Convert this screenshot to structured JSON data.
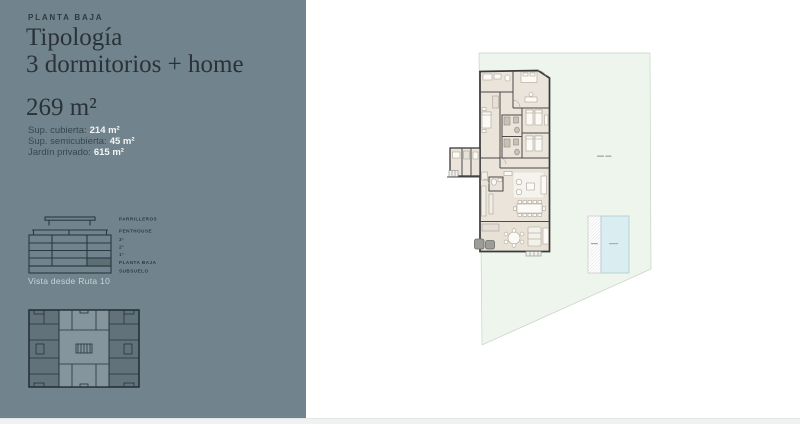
{
  "sidebar": {
    "eyebrow": "PLANTA BAJA",
    "title_line1": "Tipología",
    "title_line2": "3 dormitorios + home",
    "total_area": "269 m²",
    "details": [
      {
        "label": "Sup. cubierta:",
        "value": "214 m²"
      },
      {
        "label": "Sup. semicubierta:",
        "value": "45 m²"
      },
      {
        "label": "Jardín privado:",
        "value": "615 m²"
      }
    ],
    "elevation": {
      "levels": [
        "PARRILLEROS",
        "PENTHOUSE",
        "3°",
        "2°",
        "1°",
        "PLANTA BAJA",
        "SUBSUELO"
      ],
      "highlighted_level": "PLANTA BAJA",
      "caption": "Vista desde Ruta 10"
    }
  },
  "plan": {
    "panel_color": "#71848D",
    "garden_color": "#EDF5ED",
    "garden_border_color": "#C6D4C6",
    "pool_color": "#DAEEF2",
    "pool_border_color": "#A9C6CC",
    "floor_color": "#EAE4DA",
    "deck_color": "#E7E1D6",
    "wall_color": "#3A3A3A",
    "highlight_cell_color": "#5E6E75"
  }
}
